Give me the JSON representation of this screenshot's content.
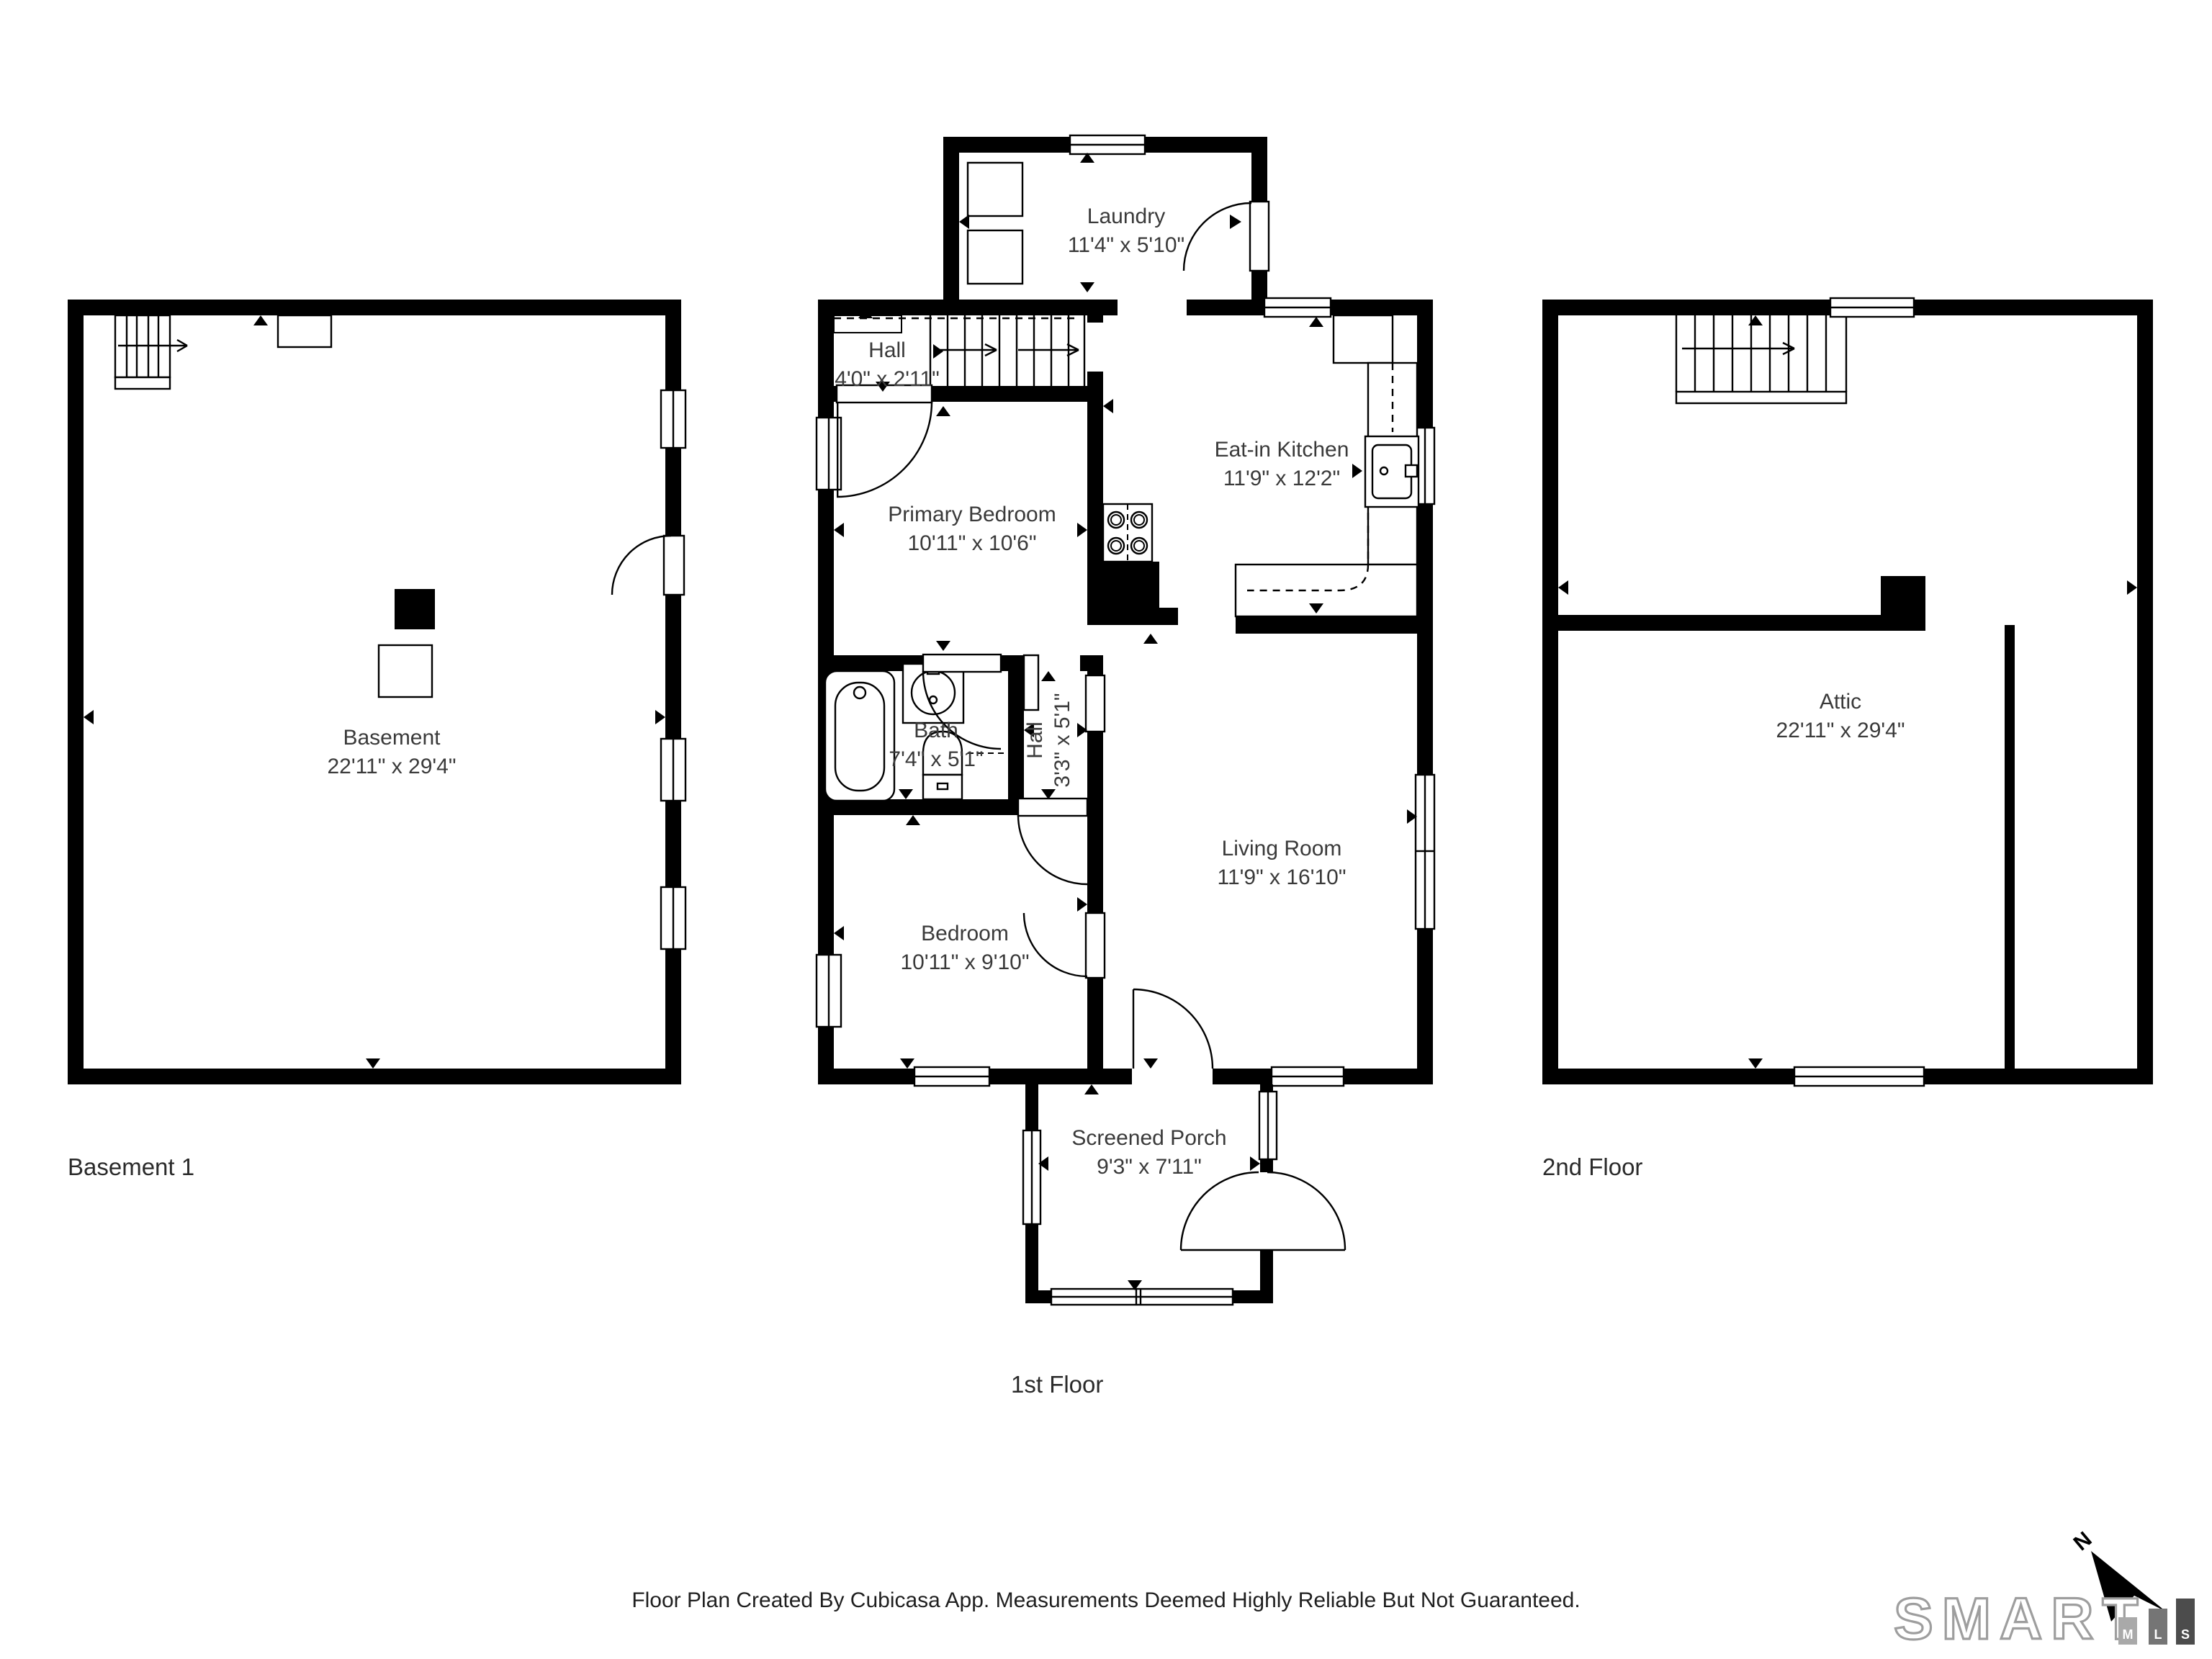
{
  "plans": {
    "basement": {
      "floor_label": "Basement 1",
      "rooms": {
        "basement": {
          "name": "Basement",
          "dims": "22'11\" x 29'4\""
        }
      }
    },
    "first": {
      "floor_label": "1st Floor",
      "rooms": {
        "laundry": {
          "name": "Laundry",
          "dims": "11'4\" x 5'10\""
        },
        "hall_upper": {
          "name": "Hall",
          "dims": "4'0\" x 2'11\""
        },
        "primary_bedroom": {
          "name": "Primary Bedroom",
          "dims": "10'11\" x 10'6\""
        },
        "kitchen": {
          "name": "Eat-in Kitchen",
          "dims": "11'9\" x 12'2\""
        },
        "bath": {
          "name": "Bath",
          "dims": "7'4\" x 5'1\""
        },
        "hall_lower": {
          "name": "Hall",
          "dims": "3'3\" x 5'1\""
        },
        "living_room": {
          "name": "Living Room",
          "dims": "11'9\" x 16'10\""
        },
        "bedroom": {
          "name": "Bedroom",
          "dims": "10'11\" x 9'10\""
        },
        "screened_porch": {
          "name": "Screened Porch",
          "dims": "9'3\" x 7'11\""
        }
      }
    },
    "second": {
      "floor_label": "2nd Floor",
      "rooms": {
        "attic": {
          "name": "Attic",
          "dims": "22'11\" x 29'4\""
        }
      }
    }
  },
  "footer": {
    "disclaimer": "Floor Plan Created By Cubicasa App. Measurements Deemed Highly Reliable But Not Guaranteed."
  },
  "branding": {
    "logo_text": "SMART",
    "mls": [
      "M",
      "L",
      "S"
    ],
    "compass_label": "N"
  },
  "colors": {
    "wall": "#000000",
    "label_text": "#3a3a3a",
    "logo_outline": "#9e9e9e",
    "mls_bar_m": "#a9a9a9",
    "mls_bar_l": "#757575",
    "mls_bar_s": "#4c4c4c"
  }
}
